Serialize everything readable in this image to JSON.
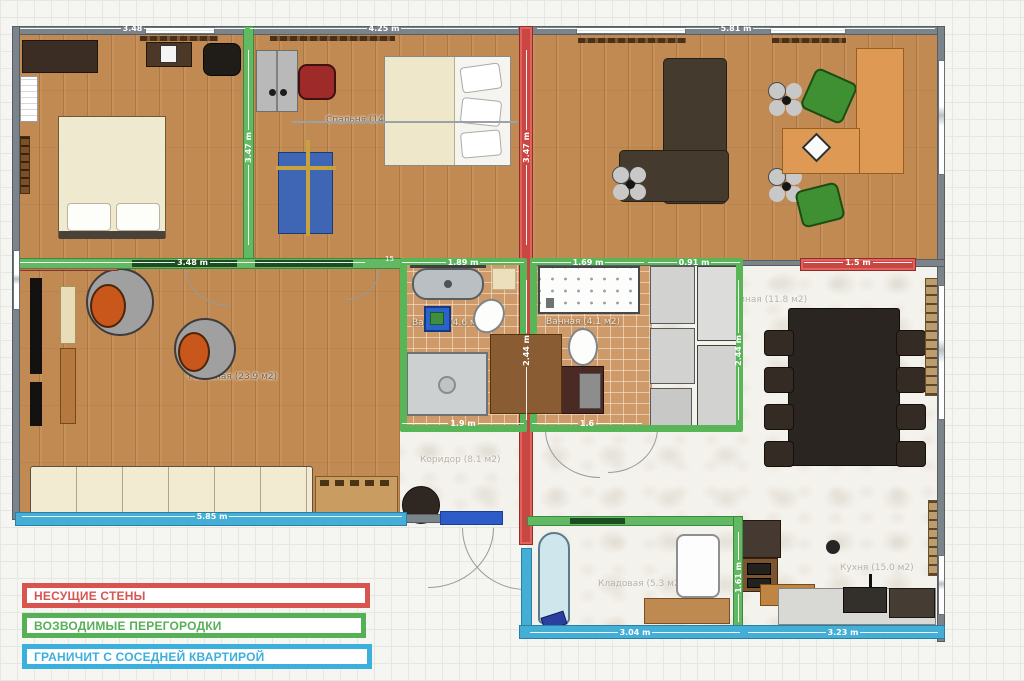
{
  "plan": {
    "rooms": {
      "bedroom": "Спальня (14.8 м2)",
      "living": "Гостиная (23.9 м2)",
      "bath_small": "Ванная (4.6 м2)",
      "bath_large": "Ванная (4.1 м2)",
      "dining": "Гостиная (11.8 м2)",
      "corridor": "Коридор (8.1 м2)",
      "storage": "Кладовая (5.3 м2)",
      "kitchen": "Кухня (15.0 м2)"
    },
    "dimensions": {
      "top_left": "3.48",
      "top_mid": "4.25 m",
      "top_right": "5.81 m",
      "bedroom_wall_green": "3.47 m",
      "bedroom_wall_red": "3.47 m",
      "bath_wall_red": "2.44 m",
      "bath_wall_green": "2.44 m",
      "mid_living": "3.48 m",
      "mid_small": "15",
      "bath_small_top": "1.89 m",
      "bath_large_top": "1.69 m",
      "bath_large_top2": "0.91 m",
      "dining_red": "1.5 m",
      "bath_small_bottom": "1.9 m",
      "bath_large_bottom": "1.6",
      "living_bottom": "5.85 m",
      "storage_right": "1.61 m",
      "bottom_storage": "3.04 m",
      "bottom_kitchen": "3.23 m"
    },
    "colors": {
      "load_bearing_wall": "#c94743",
      "partition_wall": "#58b558",
      "neighbor_wall": "#45aed6",
      "outer_wall": "#7b848b"
    }
  },
  "legend": {
    "items": [
      {
        "label": "НЕСУЩИЕ СТЕНЫ",
        "color": "#d9534f"
      },
      {
        "label": "ВОЗВОДИМЫЕ ПЕРЕГОРОДКИ",
        "color": "#56b156"
      },
      {
        "label": "ГРАНИЧИТ С СОСЕДНЕЙ КВАРТИРОЙ",
        "color": "#3cb0dc"
      }
    ]
  }
}
